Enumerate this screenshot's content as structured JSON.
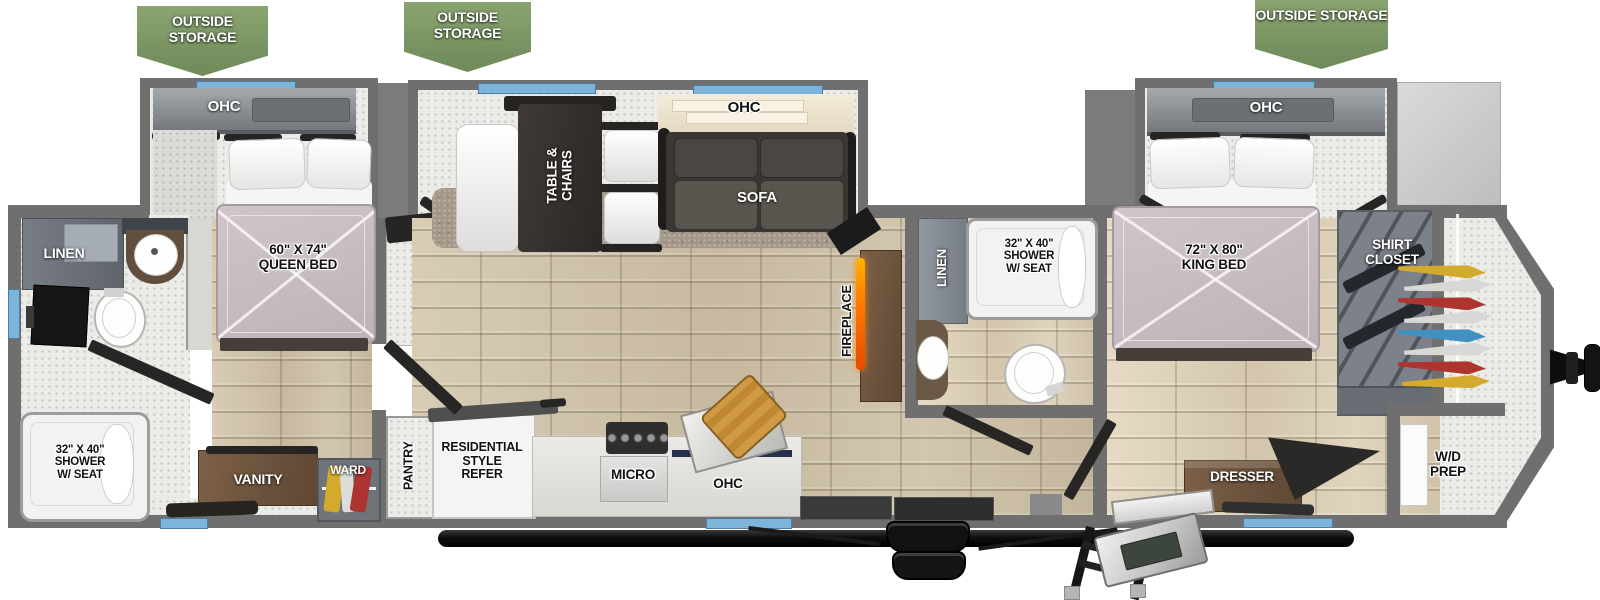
{
  "banners": [
    "OUTSIDE STORAGE",
    "OUTSIDE STORAGE",
    "OUTSIDE STORAGE"
  ],
  "rear_bedroom": {
    "ohc": "OHC",
    "bed": "60\" X 74\"\nQUEEN BED",
    "vanity": "VANITY",
    "wardrobe": "WARD"
  },
  "rear_bathroom": {
    "linen": "LINEN",
    "shower": "32\" X 40\"\nSHOWER\nW/ SEAT"
  },
  "living_area": {
    "dinette": "TABLE &\nCHAIRS",
    "ohc": "OHC",
    "sofa": "SOFA",
    "fireplace": "FIREPLACE"
  },
  "kitchen": {
    "pantry": "PANTRY",
    "refrigerator": "RESIDENTIAL\nSTYLE\nREFER",
    "microwave": "MICRO",
    "ohc": "OHC"
  },
  "mid_bathroom": {
    "linen": "LINEN",
    "shower": "32\" X 40\"\nSHOWER\nW/ SEAT"
  },
  "front_bedroom": {
    "ohc": "OHC",
    "bed": "72\" X 80\"\nKING BED",
    "shirt_closet": "SHIRT\nCLOSET",
    "dresser": "DRESSER",
    "wd_prep": "W/D\nPREP"
  },
  "colors": {
    "banner_green": "#7e9a66",
    "window_blue": "#7db4da",
    "wall_gray": "#6f6f6f",
    "floor_wood": "#cdc1a9",
    "mattress_mauve": "#c7bdc2",
    "sofa_dark": "#3a3733",
    "fireplace_flame": "#ff8a00",
    "cabinet_brown": "#7d6048"
  }
}
